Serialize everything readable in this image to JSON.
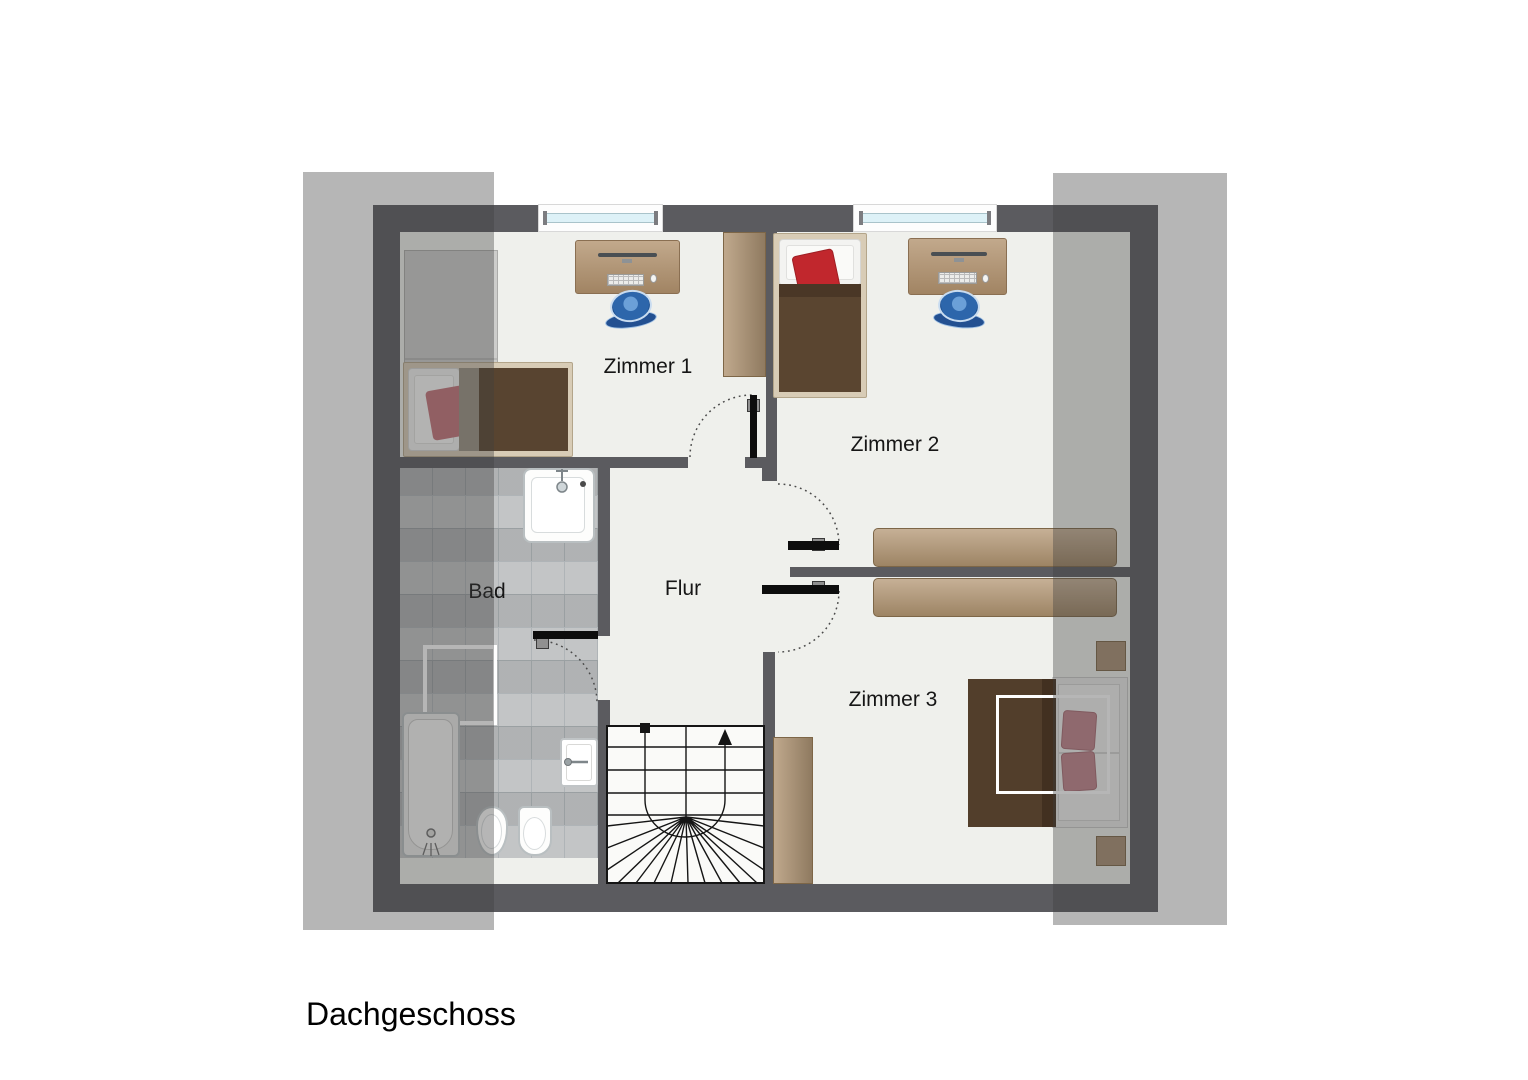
{
  "floor_title": "Dachgeschoss",
  "rooms": {
    "zimmer1": {
      "label": "Zimmer 1"
    },
    "zimmer2": {
      "label": "Zimmer 2"
    },
    "zimmer3": {
      "label": "Zimmer 3"
    },
    "bad": {
      "label": "Bad"
    },
    "flur": {
      "label": "Flur"
    }
  },
  "colors": {
    "wall": "#5b5b5f",
    "floor": "#eff0ec",
    "bath_tile": "#b9bcbd",
    "roof_slope_overlay": "rgba(62,62,64,0.38)",
    "window_glass": "#ddf1f7",
    "wood_furniture": "#a98c6e",
    "bed_blanket_brown": "#5a4530",
    "pillow_red": "#c1272d",
    "pillow_pink": "#c4737a",
    "chair_blue": "#2d66ab",
    "door_leaf": "#0d0d0d",
    "stair_line": "#151515"
  }
}
